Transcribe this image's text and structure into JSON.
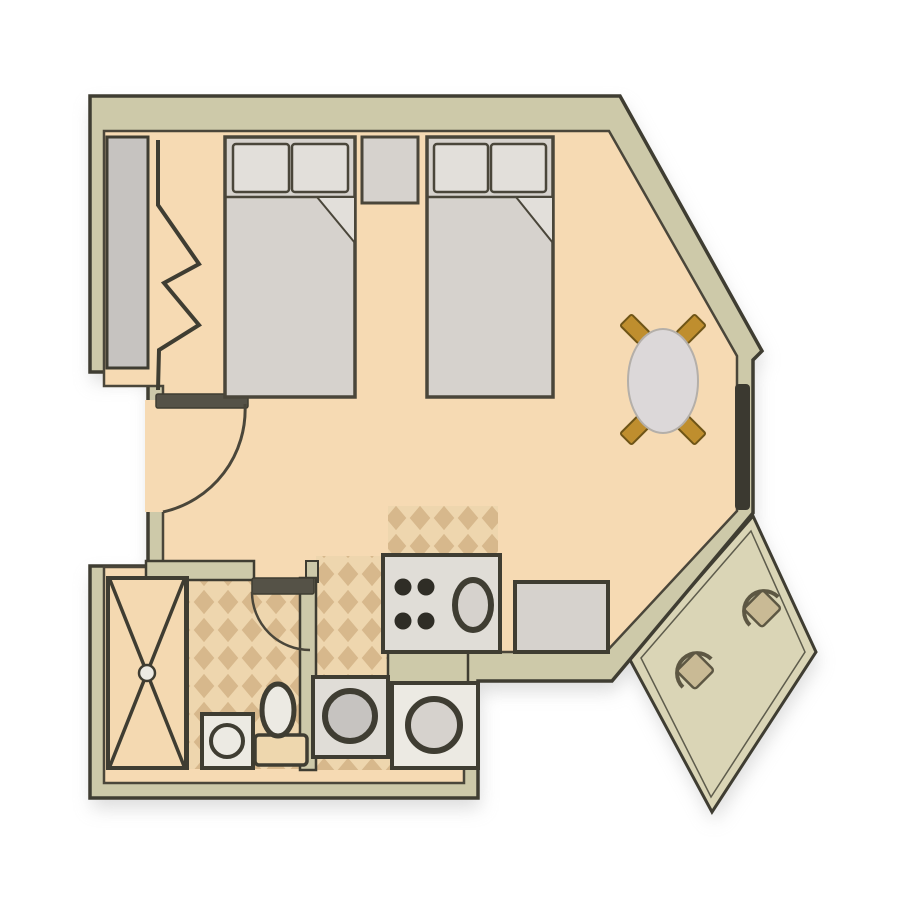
{
  "plan": {
    "type": "studio-apartment-floor-plan",
    "rooms": [
      "main-room",
      "kitchenette",
      "bathroom",
      "entry",
      "closet",
      "balcony"
    ],
    "furniture": [
      "bed-1",
      "bed-2",
      "nightstand",
      "dining-table",
      "dining-chair-x4",
      "closet-bifold-doors",
      "range-with-sink",
      "kitchen-counter",
      "washer",
      "dryer",
      "shower",
      "bathroom-sink",
      "toilet",
      "balcony-chair-1",
      "balcony-chair-2"
    ],
    "doors": [
      "entry-door",
      "bathroom-door"
    ],
    "windows": [
      "balcony-window"
    ]
  },
  "colors": {
    "background": "#ffffff",
    "wall_fill": "#cdc9a9",
    "wall_line": "#3f3d32",
    "floor": "#f6dab3",
    "floor_line": "#4a463a",
    "tile_bg": "#eed6ae",
    "tile_diamond": "#d7b88c",
    "furniture_gray": "#d6d2cd",
    "furniture_light": "#e2dfda",
    "appliance_fill": "#e0ddd7",
    "fixture_white": "#eceae3",
    "closet_gray": "#c6c3c0",
    "window_dark": "#3b3930",
    "door_leaf": "#555247",
    "balcony_floor": "#dad5b6",
    "balcony_chair": "#c9ba95",
    "balcony_chair_line": "#5d5743",
    "table_fill": "#dcd8d9",
    "table_line": "#b4afa9",
    "chair_gold": "#bf8e2e",
    "chair_gold_line": "#6f5517",
    "tank_fill": "#eed7ae",
    "shower_floor": "#f4d9b1",
    "burner_dark": "#2f2d26",
    "shadow": "#bfbfbf"
  }
}
